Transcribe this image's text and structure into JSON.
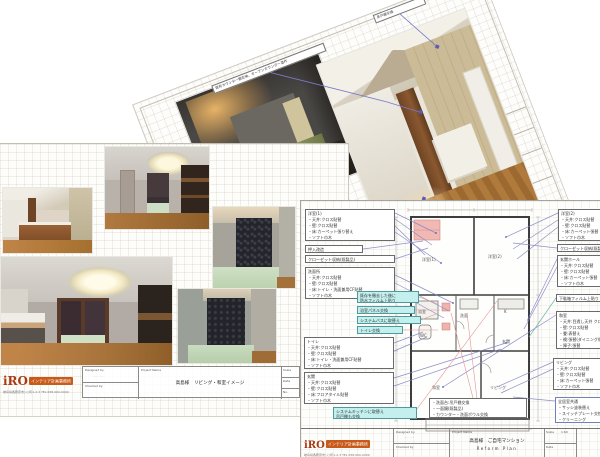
{
  "logo": {
    "name": "iRO",
    "banner": "インテリア計画事務所",
    "address": "岐阜県各務原市○○町1-2-3 TEL 058-000-0000"
  },
  "tb": {
    "designed": "Designed by",
    "checked": "Checked by",
    "project": "Project Name",
    "scale": "Scale",
    "date": "Date",
    "no": "No."
  },
  "tilted_doc": {
    "callouts": [
      "既存カウンター撤去後、オープンカウンター造作",
      "吊戸棚交換",
      "カウンター下は収納"
    ]
  },
  "left_doc": {
    "title_block": {
      "project_title": "高島様　リビング・和室イメージ",
      "designer": "····· ·····"
    }
  },
  "right_doc": {
    "left_boxes": [
      {
        "title": "洋室(1)",
        "lines": [
          "・天井:クロス貼替",
          "・壁:クロス貼替",
          "・床:カーペット張り替え",
          "・ソフト巾木"
        ]
      },
      {
        "title": "押入改造",
        "lines": []
      },
      {
        "title": "クローゼット収納(既製品)",
        "lines": []
      },
      {
        "title": "洗面所",
        "lines": [
          "・天井:クロス貼替",
          "・壁:クロス貼替",
          "・床:トイレ・洗面兼用CF貼替",
          "・ソフト巾木"
        ]
      },
      {
        "title": "トイレ",
        "lines": [
          "・天井:クロス貼替",
          "・壁:クロス貼替",
          "・床:トイレ・洗面兼用CF貼替",
          "・ソフト巾木"
        ]
      },
      {
        "title": "玄関",
        "lines": [
          "・天井:クロス貼替",
          "・壁:クロス貼替",
          "・床:フロアタイル貼替",
          "・ソフト巾木"
        ]
      }
    ],
    "cyan_boxes": [
      {
        "lines": [
          "既存を撤去した後に",
          "防水フィルム上貼り"
        ]
      },
      {
        "lines": [
          "浴室パネル交換"
        ]
      },
      {
        "lines": [
          "システムバスに取替え"
        ]
      },
      {
        "lines": [
          "トイレ交換"
        ]
      },
      {
        "lines": [
          "システムキッチンに取替え",
          "吊戸棚も交換"
        ]
      }
    ],
    "center_box": {
      "lines": [
        "・洗面台:吊戸棚交換",
        "・一面鏡(既製品)",
        "・カウンター・洗面ボウル交換"
      ]
    },
    "right_boxes": [
      {
        "title": "洋室(2)",
        "lines": [
          "・天井:クロス貼替",
          "・壁:クロス貼替",
          "・床:カーペット張替",
          "・ソフト巾木"
        ]
      },
      {
        "title": "クローゼット収納(既製品)",
        "lines": []
      },
      {
        "title": "玄関ホール",
        "lines": [
          "・天井:クロス貼替",
          "・壁:クロス貼替",
          "・床:カーペット張替",
          "・ソフト巾木"
        ]
      },
      {
        "title": "下駄箱フィルム上貼り",
        "lines": []
      },
      {
        "title": "和室",
        "lines": [
          "・天井:目透し天井 クロス貼替",
          "・壁:クロス貼替",
          "・畳:表替え",
          "・襖:張替(ダイニング側)",
          "・障子:張替"
        ]
      },
      {
        "title": "リビング",
        "lines": [
          "・天井:クロス貼替",
          "・壁:クロス貼替",
          "・床:カーペット張替",
          "・ソフト巾木"
        ]
      },
      {
        "title": "全居室共通",
        "lines": [
          "・サッシ塗装替え",
          "・スイッチプレート交換",
          "・クリーニング"
        ]
      }
    ],
    "plan_labels": {
      "y1": "洋室(1)",
      "y2": "洋室(2)",
      "wash": "洗面",
      "bath": "浴室",
      "wc": "WC",
      "k": "K",
      "lv": "リビング",
      "wa": "和室",
      "gen": "玄関"
    },
    "title_block": {
      "project_title": "高島様　ご自宅マンション",
      "project_subtitle": "Reform Plan",
      "designer": "····· ·····",
      "scale_value": "1:60"
    }
  }
}
